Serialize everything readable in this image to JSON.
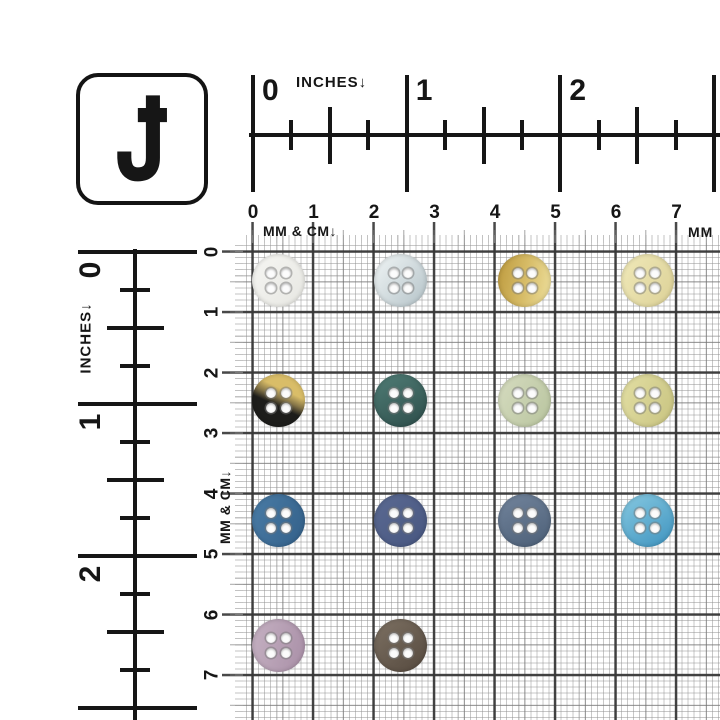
{
  "logo": {
    "letter": "J"
  },
  "top_inch_ruler": {
    "label": "INCHES↓",
    "numbers": [
      "0",
      "1",
      "2"
    ]
  },
  "top_cm_ruler": {
    "label": "MM & CM↓",
    "numbers": [
      "0",
      "1",
      "2",
      "3",
      "4",
      "5",
      "6",
      "7"
    ],
    "edge_label": "MM"
  },
  "left_inch_ruler": {
    "label": "INCHES↓",
    "numbers": [
      "0",
      "1",
      "2"
    ]
  },
  "left_cm_ruler": {
    "label": "MM & CM↓",
    "numbers": [
      "0",
      "1",
      "2",
      "3",
      "4",
      "5",
      "6",
      "7"
    ]
  },
  "colors": {
    "ruler_ink": "#161616",
    "grid_cm_line": "#3c3c3c",
    "grid_5mm_line": "#8c8c8c",
    "grid_mm_line": "#bfbfbf"
  },
  "buttons": [
    {
      "name": "white",
      "row": 0,
      "col": 0,
      "angle": 130,
      "stops": [
        "#f6f6f3",
        "#e7e7e2"
      ]
    },
    {
      "name": "pale-blue-gray",
      "row": 0,
      "col": 1,
      "angle": 130,
      "stops": [
        "#e8eeef 15%",
        "#b7c5ca 95%"
      ]
    },
    {
      "name": "gold",
      "row": 0,
      "col": 2,
      "angle": 100,
      "stops": [
        "#bd9a3e",
        "#d6bb66 50%",
        "#eee09e"
      ]
    },
    {
      "name": "cream-yellow",
      "row": 0,
      "col": 3,
      "angle": 120,
      "stops": [
        "#f0e9b9",
        "#dcd197"
      ]
    },
    {
      "name": "gold-black-two-tone",
      "row": 1,
      "col": 0,
      "angle": 205,
      "stops": [
        "#d9bd68 33%",
        "#857548 46%",
        "#1d1d1b 58%"
      ]
    },
    {
      "name": "dark-teal",
      "row": 1,
      "col": 1,
      "angle": 150,
      "stops": [
        "#507d76",
        "#2d4d4a"
      ]
    },
    {
      "name": "sage-green",
      "row": 1,
      "col": 2,
      "angle": 120,
      "stops": [
        "#d6dcc0",
        "#b8c49e"
      ]
    },
    {
      "name": "light-olive",
      "row": 1,
      "col": 3,
      "angle": 115,
      "stops": [
        "#e3dfa4",
        "#c8c380"
      ]
    },
    {
      "name": "steel-blue",
      "row": 2,
      "col": 0,
      "angle": 115,
      "stops": [
        "#4a7ca6",
        "#336089"
      ]
    },
    {
      "name": "slate-blue",
      "row": 2,
      "col": 1,
      "angle": 135,
      "stops": [
        "#5b6a92",
        "#475680"
      ]
    },
    {
      "name": "blue-gray",
      "row": 2,
      "col": 2,
      "angle": 155,
      "stops": [
        "#72849c",
        "#4c5f77"
      ]
    },
    {
      "name": "sky-blue",
      "row": 2,
      "col": 3,
      "angle": 145,
      "stops": [
        "#87c9e1",
        "#3e93bf"
      ]
    },
    {
      "name": "mauve",
      "row": 3,
      "col": 0,
      "angle": 105,
      "stops": [
        "#c5b1c2",
        "#a98fa7"
      ]
    },
    {
      "name": "taupe-brown",
      "row": 3,
      "col": 1,
      "angle": 140,
      "stops": [
        "#7d7163",
        "#55493e"
      ]
    }
  ]
}
